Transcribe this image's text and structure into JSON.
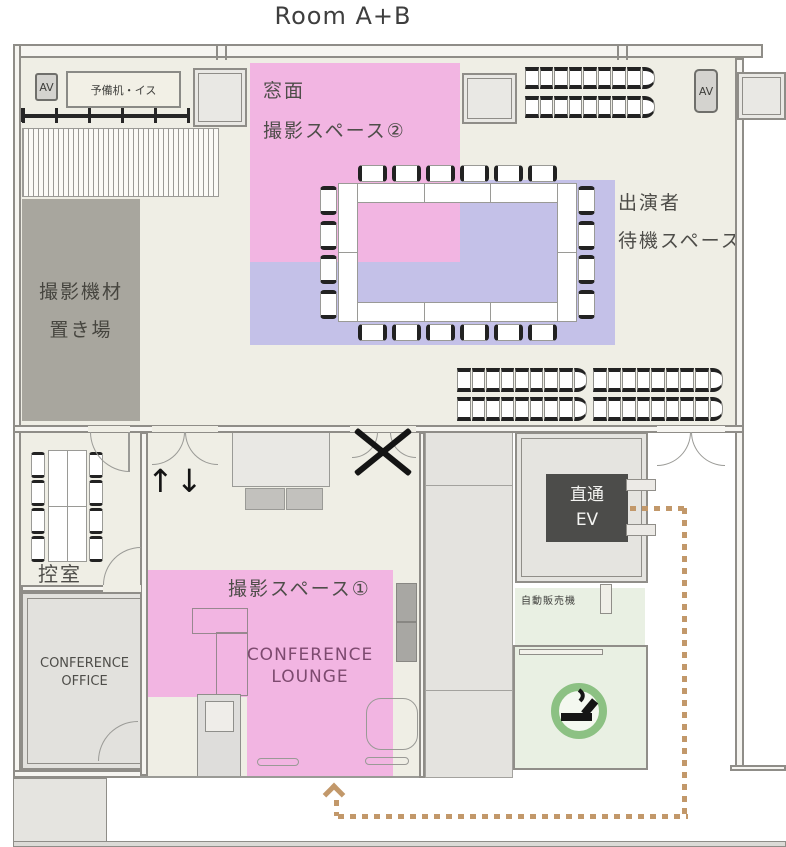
{
  "title": "Room A+B",
  "colors": {
    "pink": "#f2b5e2",
    "purple": "#c4c1e8",
    "green_room": "#e9f0e3",
    "smoking_green": "#8cc183",
    "path_tan": "#c2986a",
    "equipment_gray": "#a8a69e",
    "elevator_dark": "#4c4c4a",
    "room_cream": "#efeee5"
  },
  "upper_room": {
    "av_left": "AV",
    "spare_desk": "予備机・イス",
    "window_label_1": "窓面",
    "window_label_2": "撮影スペース②",
    "performer_label_1": "出演者",
    "performer_label_2": "待機スペース",
    "equipment_label_1": "撮影機材",
    "equipment_label_2": "置き場",
    "av_right": "AV"
  },
  "lower_floor": {
    "anteroom": "控室",
    "office_1": "CONFERENCE",
    "office_2": "OFFICE",
    "updown": "↑↓",
    "shooting_space_1": "撮影スペース①",
    "lounge_1": "CONFERENCE",
    "lounge_2": "LOUNGE",
    "elevator_1": "直通",
    "elevator_2": "EV",
    "vending": "自動販売機"
  },
  "furniture": {
    "stack_chair_count": 9,
    "table_chairs_top": 6,
    "table_chairs_bottom": 6,
    "table_chairs_left": 4,
    "table_chairs_right": 4,
    "anteroom_chairs_per_side": 4
  }
}
